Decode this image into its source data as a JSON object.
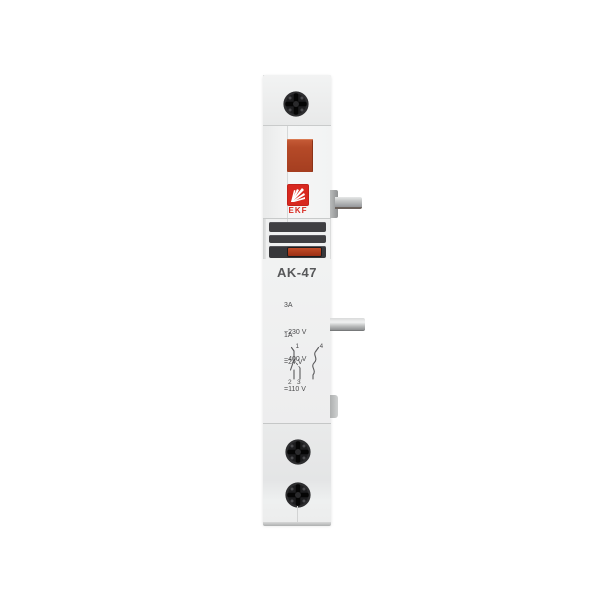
{
  "page": {
    "background": "#ffffff"
  },
  "device": {
    "brand": "EKF",
    "model": "AK-47",
    "ratings": {
      "ac": {
        "current": "3A",
        "voltages": [
          "~230 V",
          "~400 V"
        ]
      },
      "dc": {
        "current": "1A",
        "voltages": [
          "=24 V",
          "=110 V"
        ]
      }
    },
    "diagram": {
      "terminals": [
        "1",
        "2",
        "3",
        "4"
      ]
    },
    "colors": {
      "body": "#f0f1f1",
      "accent_red": "#d8281f",
      "button_red": "#b54a28",
      "stripe_dark": "#3e3e41",
      "indicator_red": "#b03d22",
      "metal": "#b0b2b3",
      "text": "#4c4c4e"
    }
  }
}
